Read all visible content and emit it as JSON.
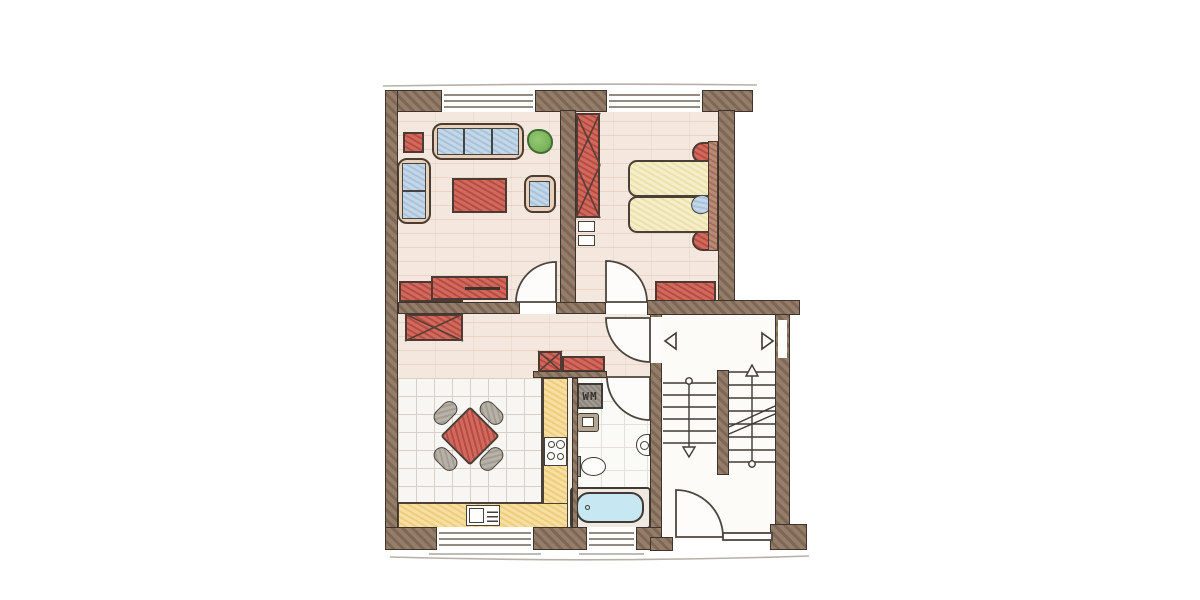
{
  "plan": {
    "type": "apartment-floor-plan-sketch",
    "labels": {
      "washing_machine": "WM"
    },
    "rooms_depicted": [
      "living-room",
      "bedroom",
      "hallway",
      "kitchen",
      "bathroom",
      "stairwell"
    ],
    "icons": {
      "stair_up_arrow": "triangle-up",
      "stair_down_arrow": "triangle-down",
      "landing_marker_left": "triangle-left",
      "landing_marker_right": "triangle-right",
      "plant": "green-blob"
    }
  },
  "colors": {
    "wall1": "#947e6a",
    "wall2": "#7d6755",
    "line": "#4a4038",
    "edge": "#3f342b",
    "floor_pink": "#f4e8de",
    "red1": "#d06a5e",
    "red2": "#b94c41",
    "blue1": "#c3d7e8",
    "blue2": "#a9c3da",
    "bed1": "#f4eec9",
    "bed2": "#ece1ad",
    "counter1": "#f6dfa0",
    "counter2": "#eecd7f",
    "gray1": "#b7b1a8",
    "gray2": "#a49d93",
    "wm1": "#a29c94",
    "wm2": "#8d867e",
    "tan": "#e8d0ba",
    "tub": "#c7e8f3",
    "plant": "#7db55e",
    "tile_bg": "#f8f6f3",
    "tile_line": "#d8d0c6"
  }
}
